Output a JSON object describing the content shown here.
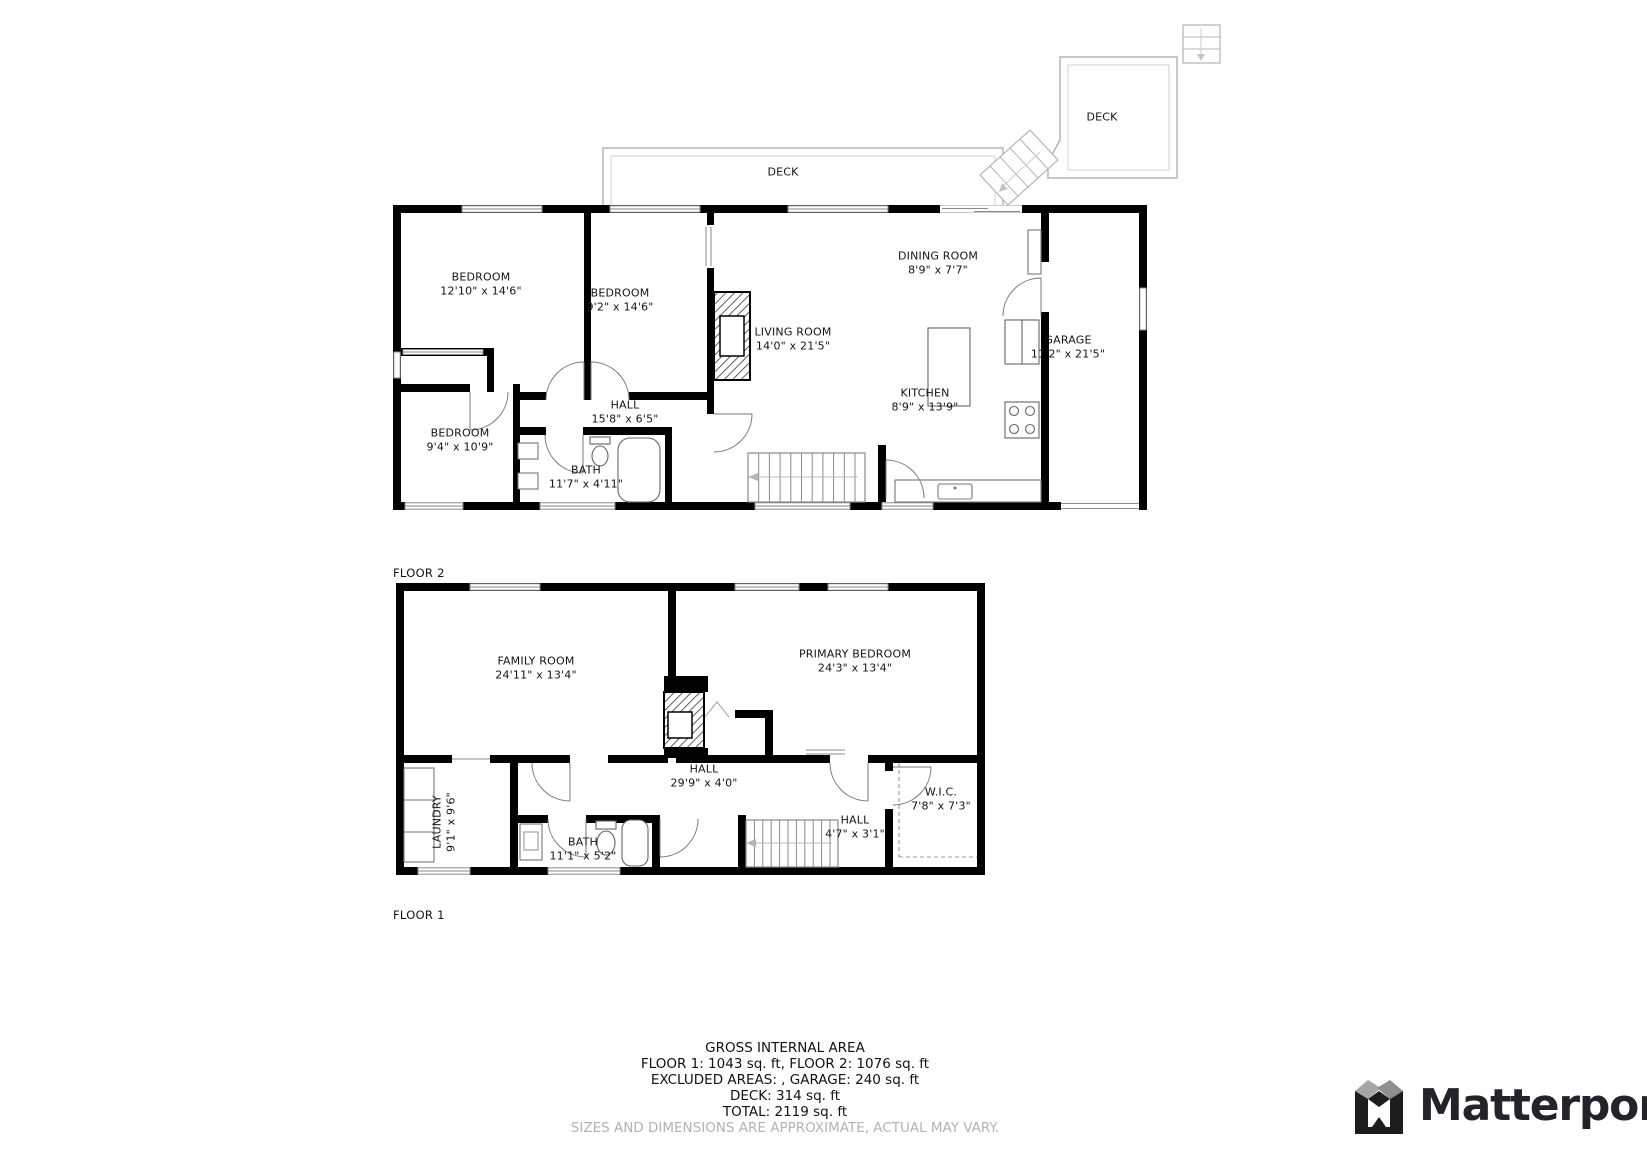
{
  "floor2": {
    "label": "FLOOR 2",
    "rooms": [
      {
        "name": "BEDROOM",
        "dims": "12'10\" x 14'6\""
      },
      {
        "name": "BEDROOM",
        "dims": "9'2\" x 14'6\""
      },
      {
        "name": "BEDROOM",
        "dims": "9'4\" x 10'9\""
      },
      {
        "name": "HALL",
        "dims": "15'8\" x 6'5\""
      },
      {
        "name": "BATH",
        "dims": "11'7\" x 4'11\""
      },
      {
        "name": "LIVING ROOM",
        "dims": "14'0\" x 21'5\""
      },
      {
        "name": "DINING ROOM",
        "dims": "8'9\" x 7'7\""
      },
      {
        "name": "KITCHEN",
        "dims": "8'9\" x 13'9\""
      },
      {
        "name": "GARAGE",
        "dims": "11'2\" x 21'5\""
      }
    ],
    "deck_upper_label": "DECK",
    "deck_long_label": "DECK"
  },
  "floor1": {
    "label": "FLOOR 1",
    "rooms": [
      {
        "name": "FAMILY ROOM",
        "dims": "24'11\" x 13'4\""
      },
      {
        "name": "PRIMARY BEDROOM",
        "dims": "24'3\" x 13'4\""
      },
      {
        "name": "HALL",
        "dims": "29'9\" x 4'0\""
      },
      {
        "name": "LAUNDRY",
        "dims": "9'1\" x 9'6\""
      },
      {
        "name": "BATH",
        "dims": "11'1\" x 5'2\""
      },
      {
        "name": "HALL",
        "dims": "4'7\" x 3'1\""
      },
      {
        "name": "W.I.C.",
        "dims": "7'8\" x 7'3\""
      }
    ]
  },
  "footer": {
    "title": "GROSS INTERNAL AREA",
    "line1": "FLOOR 1: 1043 sq. ft, FLOOR 2: 1076 sq. ft",
    "line2": "EXCLUDED AREAS: , GARAGE: 240 sq. ft",
    "line3": "DECK: 314 sq. ft",
    "line4": "TOTAL: 2119 sq. ft",
    "disclaimer": "SIZES AND DIMENSIONS ARE APPROXIMATE, ACTUAL MAY VARY."
  },
  "branding": {
    "logo_text": "Matterport"
  },
  "colors": {
    "wall": "#000000",
    "deck_line": "#b5b5b5",
    "fixture_line": "#666666",
    "disclaimer_text": "#b3b3b3",
    "logo_dark": "#1d1d1f"
  }
}
